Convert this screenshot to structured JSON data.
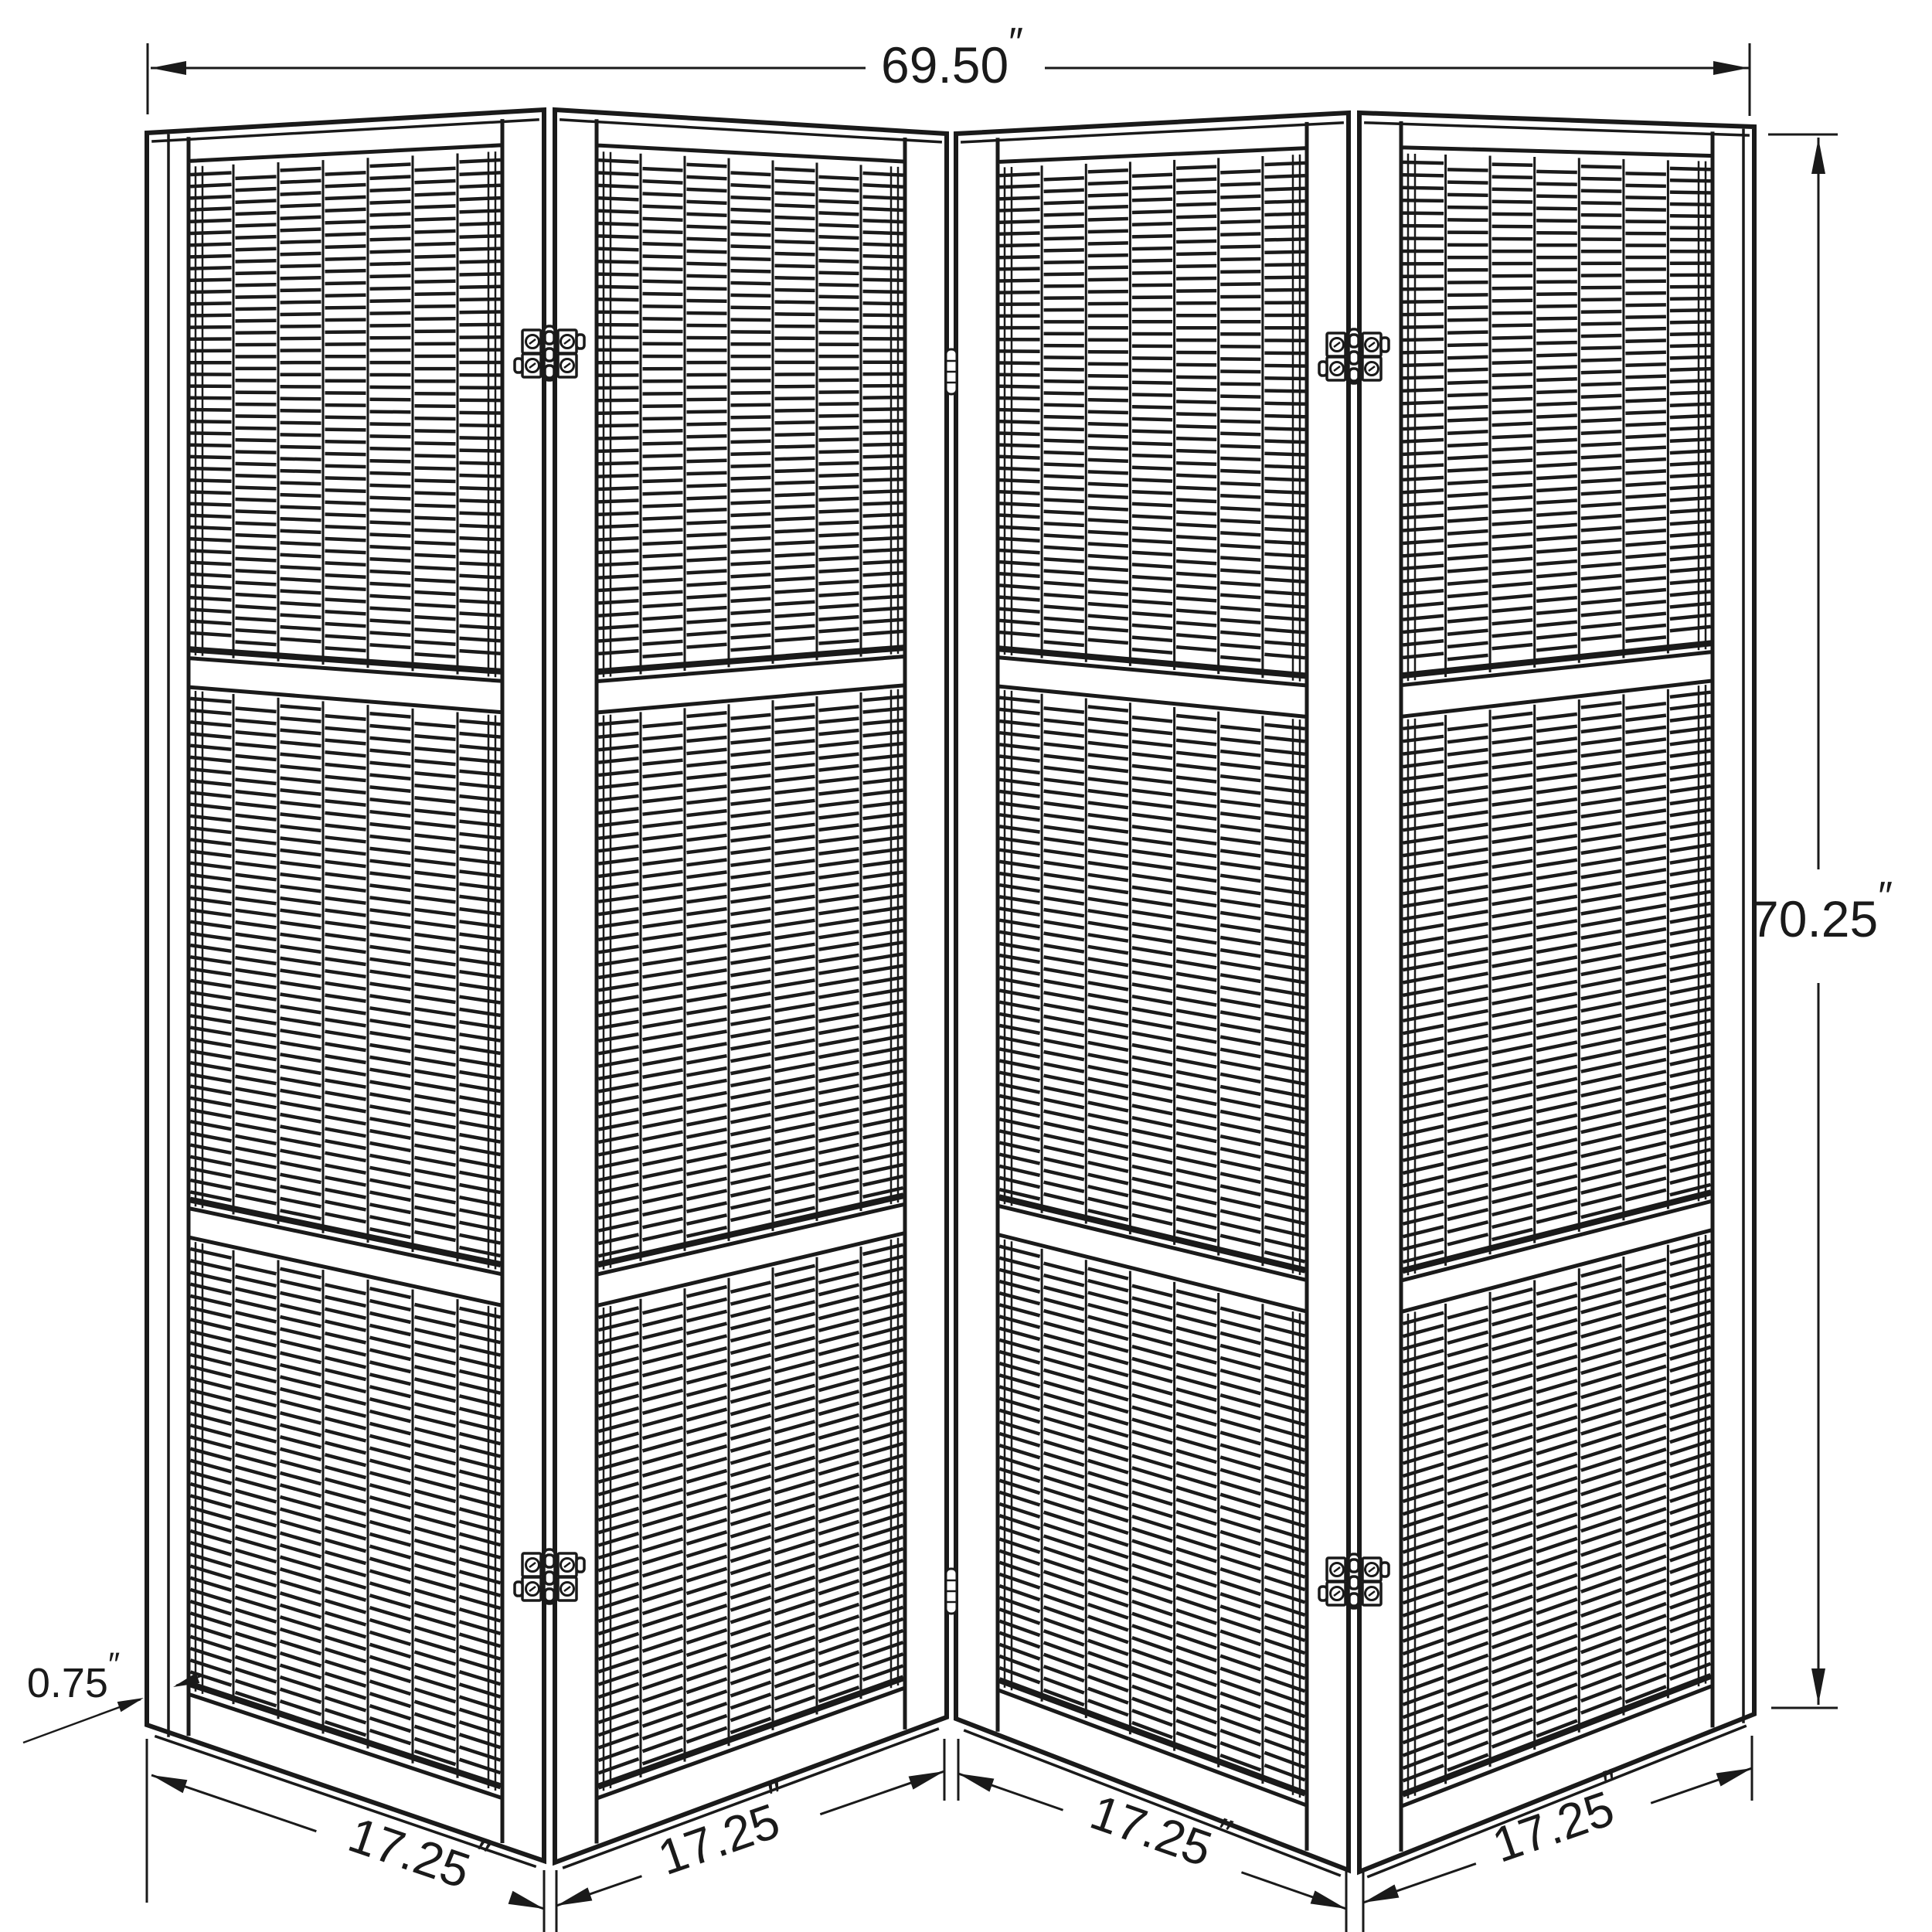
{
  "drawing": {
    "type": "furniture-dimension-diagram",
    "subject": "four panel folding room divider screen with slatted panels",
    "background": "#ffffff",
    "line_color": "#1a1a1a",
    "unit_mark": "″",
    "dimensions": {
      "overall_width": "69.50",
      "overall_height": "70.25",
      "panel_thickness": "0.75",
      "panel_widths": [
        "17.25",
        "17.25",
        "17.25",
        "17.25"
      ]
    },
    "structure": {
      "panel_count": 4,
      "sections_per_panel": 3,
      "slat_columns_per_panel": 7,
      "hinges": [
        "top-hinge-panels-1-2",
        "bottom-hinge-panels-1-2",
        "top-barrel-panels-2-3",
        "bottom-barrel-panels-2-3",
        "top-hinge-panels-3-4",
        "bottom-hinge-panels-3-4"
      ]
    }
  }
}
